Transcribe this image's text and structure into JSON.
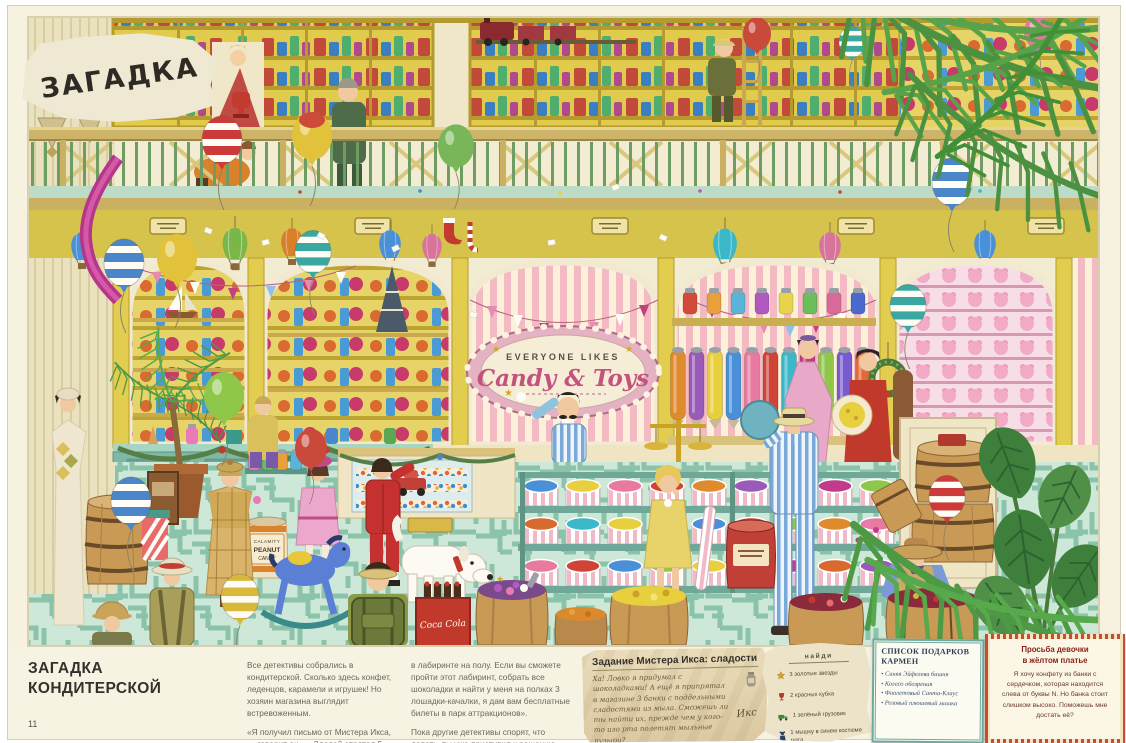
{
  "page": {
    "corner_label": "ЗАГАДКА",
    "page_number": "11",
    "title_line1": "ЗАГАДКА",
    "title_line2": "КОНДИТЕРСКОЙ",
    "intro_col1_p1": "Все детективы собрались в кондитерской. Сколько здесь конфет, леденцов, карамели и игрушек! Но хозяин магазина выглядит встревоженным.",
    "intro_col1_p2": "«Я получил письмо от Мистера Икса, — говорит он. — Злодей спрятал 5 шоколадных плиток",
    "intro_col2_p1": "в лабиринте на полу. Если вы сможете пройти этот лабиринт, собрать все шоколадки и найти у меня на полках 3 лошадки-качалки, я дам вам бесплатные билеты в парк аттракционов».",
    "intro_col2_p2": "Пока другие детективы спорят, что делать, ты уже приступил к решению головоломки!"
  },
  "notes": {
    "mister_x": {
      "title": "Задание Мистера Икса: сладости",
      "body": "Ха! Ловко я придумал с шоколадками! А ещё я припрятал в магазине 3 банки с поддельными сладостями из мыла. Сможешь ли ты найти их, прежде чем у кого-то изо рта полетят мыльные пузыри?",
      "signature": "Икс"
    },
    "find_list": {
      "title": "найди",
      "items": [
        {
          "icon": "gold-star",
          "label": "3 золотые звезды"
        },
        {
          "icon": "red-goblet",
          "label": "2 красных кубка"
        },
        {
          "icon": "green-truck",
          "label": "1 зелёный грузовик"
        },
        {
          "icon": "mouse-figure",
          "label": "1 мышку в синем костюме мага"
        }
      ]
    },
    "carmen_gifts": {
      "title": "СПИСОК ПОДАРКОВ КАРМЕН",
      "items": [
        "Синяя Эйфелева башня",
        "Колесо обозрения",
        "Фиолетовый Санта-Клаус",
        "Розовый плюшевый мишка"
      ]
    },
    "yellow_dress_girl": {
      "title_line1": "Просьба девочки",
      "title_line2": "в жёлтом платье",
      "body": "Я хочу конфету из банки с сердечком, которая находится слева от буквы N. Но банка стоит слишком высоко. Поможешь мне достать её?"
    }
  },
  "illustration": {
    "shop_sign_top": "EVERYONE LIKES",
    "shop_sign_main": "Candy & Toys",
    "peanut_tin": {
      "line1": "CALAMITY",
      "line2": "PEANUT",
      "line3": "CANDY"
    },
    "cola_label": "Coca Cola",
    "colors": {
      "floor_teal": "#cde8d8",
      "maze_line": "#8ac3a9",
      "shelf_yellow": "#e0cb4d",
      "wall_pink_stripe": "#f3bac4",
      "railing_green": "#6f9c63",
      "sign_pink": "#c4527e"
    }
  }
}
